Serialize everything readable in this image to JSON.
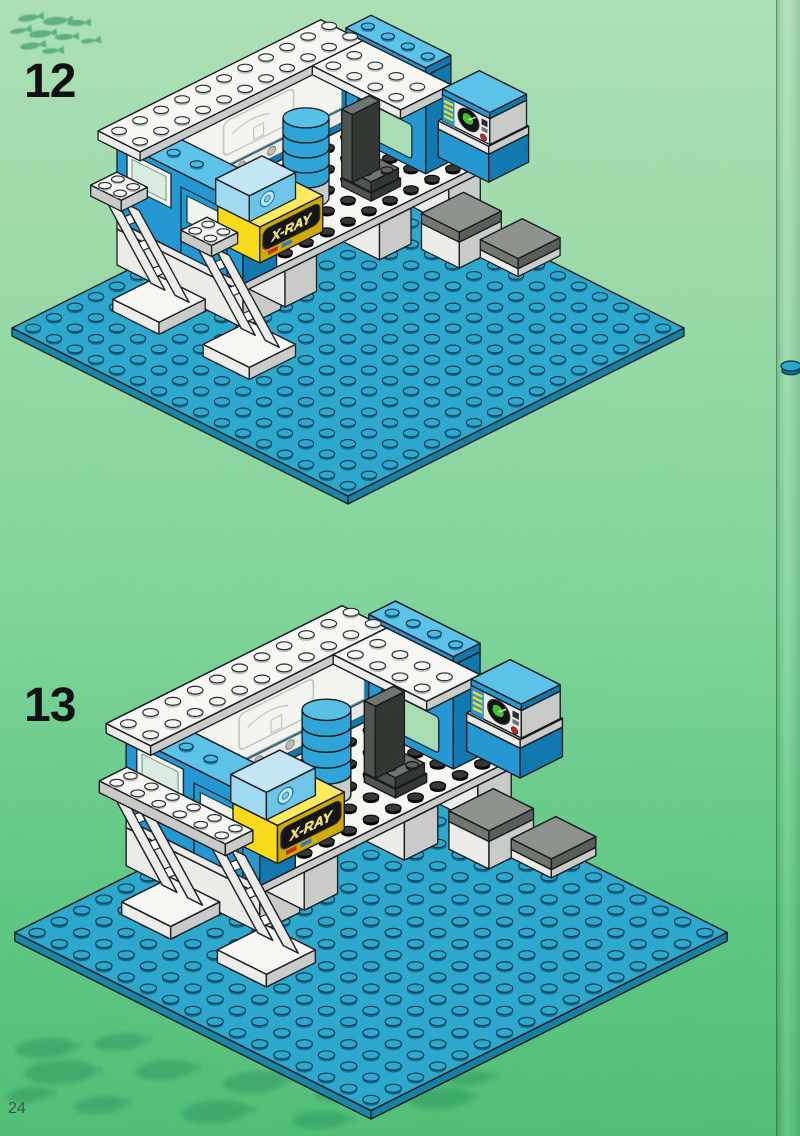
{
  "page": {
    "number": "24"
  },
  "steps": [
    {
      "number": "12"
    },
    {
      "number": "13"
    }
  ],
  "model": {
    "xray_label": "X-RAY"
  },
  "colors": {
    "baseplate_blue": "#29a7cc",
    "baseplate_side": "#127ea3",
    "wall_blue": "#2196d1",
    "wall_blue_top": "#5ac2e8",
    "wall_blue_dark": "#0d76ad",
    "brick_yellow": "#f9da17",
    "trans_blue": "#9fd9f0",
    "chair_gray": "#4c514c",
    "tread_gray": "#8c918b",
    "screen_green": "#3fc224",
    "alert_red": "#c9251b",
    "label_black": "#111111",
    "outline": "#14181d",
    "background_top": "#abdfb5",
    "background_bottom": "#4fbe74",
    "fish_green": "#1e8a57"
  }
}
